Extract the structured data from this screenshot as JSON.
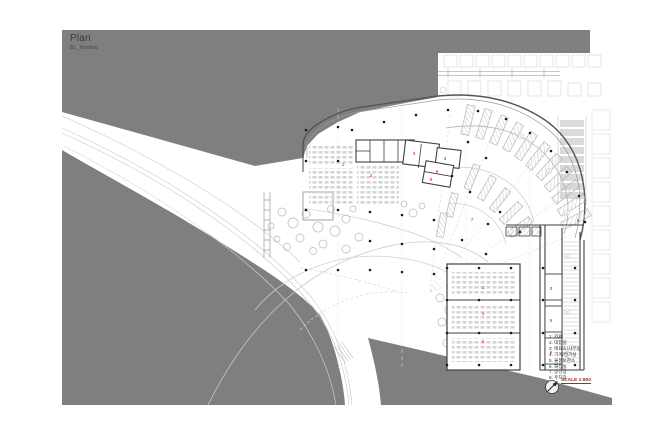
{
  "title": {
    "main": "Plan",
    "sub": "B1_Terminal"
  },
  "legend": {
    "items": [
      {
        "num": "1",
        "label": "카페"
      },
      {
        "num": "2",
        "label": "대합실"
      },
      {
        "num": "3",
        "label": "매표소/사무실"
      },
      {
        "num": "4",
        "label": "기계/전기실"
      },
      {
        "num": "5",
        "label": "물품보관소"
      },
      {
        "num": "6",
        "label": "화장실"
      },
      {
        "num": "7",
        "label": "승강장"
      },
      {
        "num": "8",
        "label": "주차장"
      }
    ],
    "scale_label": "SCALE 1:800"
  },
  "plan_labels": [
    {
      "t": "1",
      "x": 343,
      "y": 166
    },
    {
      "t": "2",
      "x": 371,
      "y": 177
    },
    {
      "t": "3",
      "x": 414,
      "y": 155
    },
    {
      "t": "4",
      "x": 445,
      "y": 160
    },
    {
      "t": "5",
      "x": 437,
      "y": 173
    },
    {
      "t": "6",
      "x": 431,
      "y": 181
    },
    {
      "t": "7",
      "x": 472,
      "y": 221
    },
    {
      "t": "8",
      "x": 578,
      "y": 222
    },
    {
      "t": "1",
      "x": 483,
      "y": 289
    },
    {
      "t": "1",
      "x": 483,
      "y": 315
    },
    {
      "t": "2",
      "x": 483,
      "y": 343
    },
    {
      "t": "3",
      "x": 551,
      "y": 290
    },
    {
      "t": "5",
      "x": 551,
      "y": 322
    },
    {
      "t": "6",
      "x": 551,
      "y": 354
    }
  ],
  "grid_bubbles": [
    {
      "t": "1",
      "x": 521,
      "y": 136
    },
    {
      "t": "2",
      "x": 549,
      "y": 171
    },
    {
      "t": "3",
      "x": 567,
      "y": 213
    },
    {
      "t": "4",
      "x": 567,
      "y": 256
    },
    {
      "t": "5",
      "x": 567,
      "y": 312
    },
    {
      "t": "6",
      "x": 567,
      "y": 354
    }
  ],
  "colors": {
    "background_mask": "#7f7f7f",
    "paper": "#ffffff",
    "line_dark": "#474747",
    "line_light": "#c3c3c3",
    "room_label": "#e0524e",
    "scale_text": "#93322a"
  }
}
